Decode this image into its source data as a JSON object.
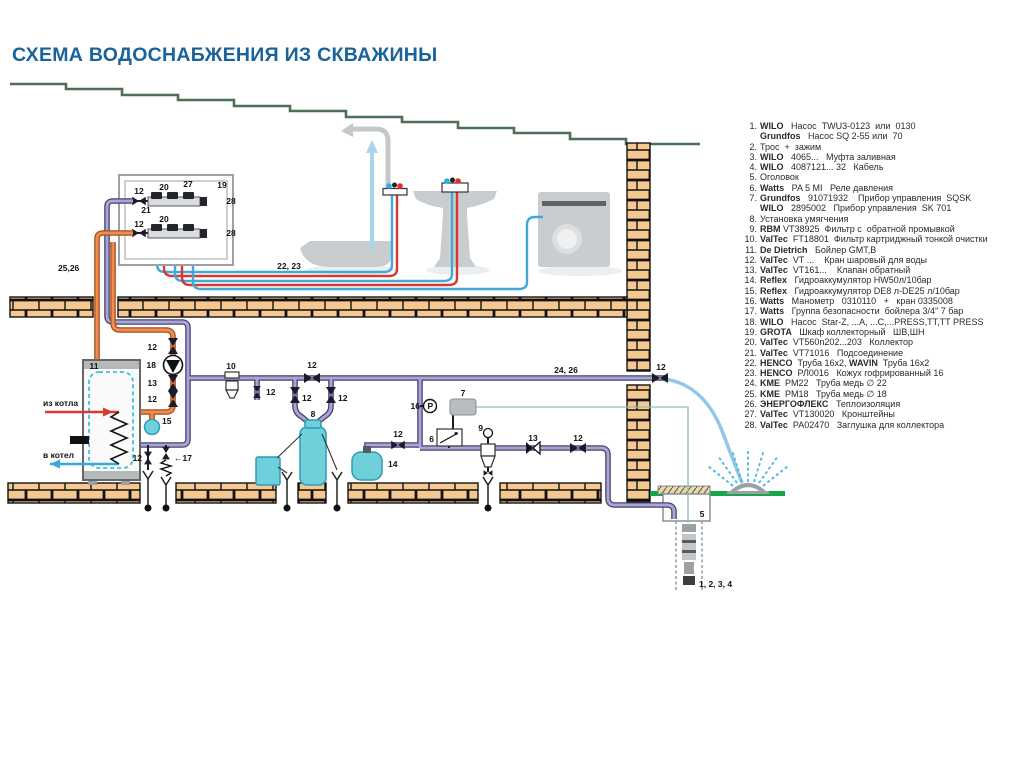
{
  "title": "СХЕМА ВОДОСНАБЖЕНИЯ ИЗ СКВАЖИНЫ",
  "colors": {
    "title": "#19629a",
    "roof": "#4e6f57",
    "brick": "#f4c88f",
    "pipe_cold": "#aaa5d5",
    "pipe_hot": "#f08c50",
    "pipe_red": "#d9382e",
    "pipe_cyan": "#3fa9da",
    "hose": "#8fc8e8",
    "ground": "#17a44a",
    "equipment_cyan": "#6fd0dc",
    "cable": "#8fbdb2"
  },
  "legend": {
    "items": [
      {
        "n": "1.",
        "lines": [
          [
            {
              "b": true,
              "t": "WILO"
            },
            {
              "t": "   Насос  TWU3-0123  или  0130"
            }
          ],
          [
            {
              "b": true,
              "t": "Grundfos"
            },
            {
              "t": "   Насос SQ 2-55 или  70"
            }
          ]
        ]
      },
      {
        "n": "2.",
        "lines": [
          [
            {
              "t": "Трос  +  зажим"
            }
          ]
        ]
      },
      {
        "n": "3.",
        "lines": [
          [
            {
              "b": true,
              "t": "WILO"
            },
            {
              "t": "   4065...   Муфта заливная"
            }
          ]
        ]
      },
      {
        "n": "4.",
        "lines": [
          [
            {
              "b": true,
              "t": "WILO"
            },
            {
              "t": "   4087121... 32   Кабель"
            }
          ]
        ]
      },
      {
        "n": "5.",
        "lines": [
          [
            {
              "t": "Оголовок"
            }
          ]
        ]
      },
      {
        "n": "6.",
        "lines": [
          [
            {
              "b": true,
              "t": "Watts"
            },
            {
              "t": "   PA 5 MI   Реле давления"
            }
          ]
        ]
      },
      {
        "n": "7.",
        "lines": [
          [
            {
              "b": true,
              "t": "Grundfos"
            },
            {
              "t": "   91071932    Прибор управления  SQSK"
            }
          ],
          [
            {
              "b": true,
              "t": "WILO"
            },
            {
              "t": "   2895002   Прибор управления  SK 701"
            }
          ]
        ]
      },
      {
        "n": "8.",
        "lines": [
          [
            {
              "t": "Установка умягчения"
            }
          ]
        ]
      },
      {
        "n": "9.",
        "lines": [
          [
            {
              "b": true,
              "t": "RBM"
            },
            {
              "t": " VT38925  Фильтр с  обратной промывкой"
            }
          ]
        ]
      },
      {
        "n": "10.",
        "lines": [
          [
            {
              "b": true,
              "t": "ValTec"
            },
            {
              "t": "  FT18801  Фильтр картриджный тонкой очистки"
            }
          ]
        ]
      },
      {
        "n": "11.",
        "lines": [
          [
            {
              "b": true,
              "t": "De Dietrich"
            },
            {
              "t": "   Бойлер GMT,B"
            }
          ]
        ]
      },
      {
        "n": "12.",
        "lines": [
          [
            {
              "b": true,
              "t": "ValTec"
            },
            {
              "t": "  VT ...    Кран шаровый для воды"
            }
          ]
        ]
      },
      {
        "n": "13.",
        "lines": [
          [
            {
              "b": true,
              "t": "ValTec"
            },
            {
              "t": "  VT161...    Клапан обратный"
            }
          ]
        ]
      },
      {
        "n": "14.",
        "lines": [
          [
            {
              "b": true,
              "t": "Reflex"
            },
            {
              "t": "   Гидроаккумулятор HW50л/10бар"
            }
          ]
        ]
      },
      {
        "n": "15.",
        "lines": [
          [
            {
              "b": true,
              "t": "Reflex"
            },
            {
              "t": "   Гидроаккумулятор DE8 л-DE25 л/10бар"
            }
          ]
        ]
      },
      {
        "n": "16.",
        "lines": [
          [
            {
              "b": true,
              "t": "Watts"
            },
            {
              "t": "   Манометр   0310110   +   кран 0335008"
            }
          ]
        ]
      },
      {
        "n": "17.",
        "lines": [
          [
            {
              "b": true,
              "t": "Watts"
            },
            {
              "t": "   Группа безопасности  бойлера 3/4\" 7 бар"
            }
          ]
        ]
      },
      {
        "n": "18.",
        "lines": [
          [
            {
              "b": true,
              "t": "WILO"
            },
            {
              "t": "   Насос  Star-Z, ...A, ...C,...PRESS,TT,TT PRESS"
            }
          ]
        ]
      },
      {
        "n": "19.",
        "lines": [
          [
            {
              "b": true,
              "t": "GROTA"
            },
            {
              "t": "   Шкаф коллекторный   ШВ,ШН"
            }
          ]
        ]
      },
      {
        "n": "20.",
        "lines": [
          [
            {
              "b": true,
              "t": "ValTec"
            },
            {
              "t": "  VT560n202...203   Коллектор"
            }
          ]
        ]
      },
      {
        "n": "21.",
        "lines": [
          [
            {
              "b": true,
              "t": "ValTec"
            },
            {
              "t": "  VT71016   Подсоединение"
            }
          ]
        ]
      },
      {
        "n": "22.",
        "lines": [
          [
            {
              "b": true,
              "t": "HENCO"
            },
            {
              "t": "  Труба 16х2, "
            },
            {
              "b": true,
              "t": "WAVIN"
            },
            {
              "t": "  Труба 16х2"
            }
          ]
        ]
      },
      {
        "n": "23.",
        "lines": [
          [
            {
              "b": true,
              "t": "HENCO"
            },
            {
              "t": "  РЛ0016   Кожух гофрированный 16"
            }
          ]
        ]
      },
      {
        "n": "24.",
        "lines": [
          [
            {
              "b": true,
              "t": "KME"
            },
            {
              "t": "  PM22   Труба медь ∅ 22"
            }
          ]
        ]
      },
      {
        "n": "25.",
        "lines": [
          [
            {
              "b": true,
              "t": "KME"
            },
            {
              "t": "  PM18   Труба медь ∅ 18"
            }
          ]
        ]
      },
      {
        "n": "26.",
        "lines": [
          [
            {
              "b": true,
              "t": "ЭНЕРГОФЛЕКС"
            },
            {
              "t": "   Теплоизоляция"
            }
          ]
        ]
      },
      {
        "n": "27.",
        "lines": [
          [
            {
              "b": true,
              "t": "ValTec"
            },
            {
              "t": "  VT130020   Кронштейны"
            }
          ]
        ]
      },
      {
        "n": "28.",
        "lines": [
          [
            {
              "b": true,
              "t": "ValTec"
            },
            {
              "t": "  PA02470   Заглушка для коллектора"
            }
          ]
        ]
      }
    ]
  },
  "diagram": {
    "labels": [
      {
        "t": "19",
        "x": 222,
        "y": 188
      },
      {
        "t": "12",
        "x": 139,
        "y": 194
      },
      {
        "t": "20",
        "x": 164,
        "y": 190
      },
      {
        "t": "27",
        "x": 188,
        "y": 187
      },
      {
        "t": "28",
        "x": 231,
        "y": 204
      },
      {
        "t": "21",
        "x": 146,
        "y": 213
      },
      {
        "t": "12",
        "x": 139,
        "y": 227
      },
      {
        "t": "20",
        "x": 164,
        "y": 222
      },
      {
        "t": "28",
        "x": 231,
        "y": 236
      },
      {
        "t": "25,26",
        "x": 58,
        "y": 271,
        "a": "start"
      },
      {
        "t": "22, 23",
        "x": 289,
        "y": 269
      },
      {
        "t": "11",
        "x": 94,
        "y": 369
      },
      {
        "t": "12",
        "x": 157,
        "y": 350,
        "a": "end"
      },
      {
        "t": "18",
        "x": 156,
        "y": 368,
        "a": "end"
      },
      {
        "t": "13",
        "x": 157,
        "y": 386,
        "a": "end"
      },
      {
        "t": "12",
        "x": 157,
        "y": 402,
        "a": "end"
      },
      {
        "t": "15",
        "x": 162,
        "y": 424,
        "a": "start"
      },
      {
        "t": "из котла",
        "x": 43,
        "y": 406,
        "a": "start"
      },
      {
        "t": "в котел",
        "x": 43,
        "y": 458,
        "a": "start"
      },
      {
        "t": "12",
        "x": 142,
        "y": 461,
        "a": "end"
      },
      {
        "t": "←17",
        "x": 174,
        "y": 461,
        "a": "start"
      },
      {
        "t": "10",
        "x": 231,
        "y": 369
      },
      {
        "t": "12",
        "x": 266,
        "y": 395,
        "a": "start"
      },
      {
        "t": "12",
        "x": 312,
        "y": 368
      },
      {
        "t": "12",
        "x": 302,
        "y": 401,
        "a": "start"
      },
      {
        "t": "12",
        "x": 338,
        "y": 401,
        "a": "start"
      },
      {
        "t": "8",
        "x": 313,
        "y": 417
      },
      {
        "t": "14",
        "x": 388,
        "y": 467,
        "a": "start"
      },
      {
        "t": "12",
        "x": 398,
        "y": 437
      },
      {
        "t": "16",
        "x": 420,
        "y": 409,
        "a": "end"
      },
      {
        "t": "P",
        "x": 430.3,
        "y": 408.8,
        "s": 6.5
      },
      {
        "t": "24, 26",
        "x": 566,
        "y": 373
      },
      {
        "t": "7",
        "x": 463,
        "y": 396
      },
      {
        "t": "6",
        "x": 434,
        "y": 442,
        "a": "end"
      },
      {
        "t": "9",
        "x": 483,
        "y": 431,
        "a": "end"
      },
      {
        "t": "13",
        "x": 533,
        "y": 441
      },
      {
        "t": "12",
        "x": 578,
        "y": 441
      },
      {
        "t": "12",
        "x": 661,
        "y": 370
      },
      {
        "t": "5",
        "x": 702,
        "y": 517
      },
      {
        "t": "1, 2, 3, 4",
        "x": 699,
        "y": 587,
        "a": "start"
      }
    ]
  }
}
